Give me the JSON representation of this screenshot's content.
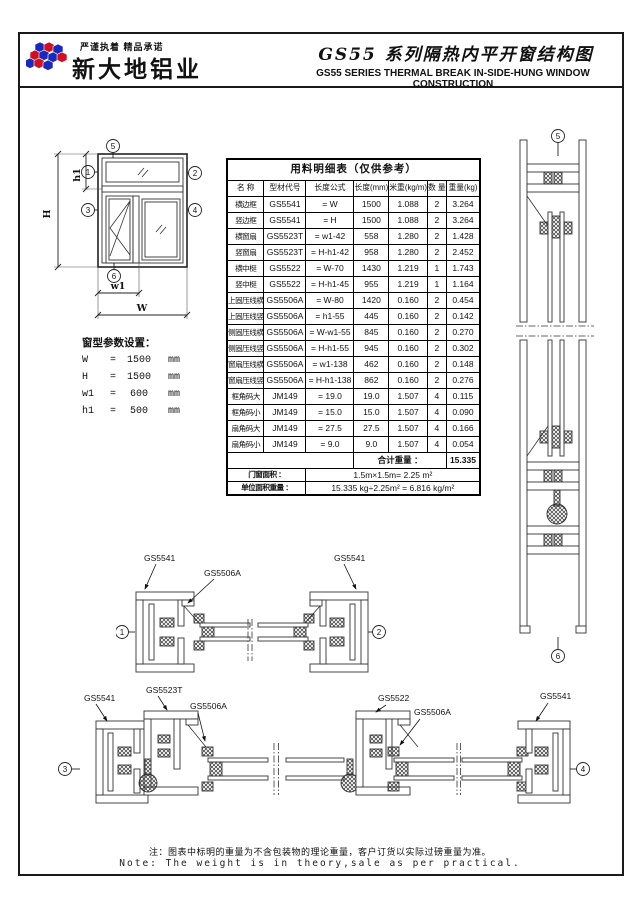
{
  "header": {
    "slogan": "严谨执着  精品承诺",
    "company": "新大地铝业",
    "title_cn": "GS55 系列隔热内平开窗结构图",
    "title_en": "GS55 SERIES THERMAL BREAK IN-SIDE-HUNG WINDOW CONSTRUCTION",
    "logo_blue": "#1828c0",
    "logo_red": "#d01020"
  },
  "window_diagram": {
    "refs": {
      "r1": "1",
      "r2": "2",
      "r3": "3",
      "r4": "4",
      "r5": "5",
      "r6": "6"
    },
    "dims": {
      "W": "W",
      "H": "H",
      "w1": "w1",
      "h1": "h1"
    }
  },
  "params": {
    "title": "窗型参数设置：",
    "rows": [
      {
        "name": "W",
        "eq": "=",
        "value": "1500",
        "unit": "mm"
      },
      {
        "name": "H",
        "eq": "=",
        "value": "1500",
        "unit": "mm"
      },
      {
        "name": "w1",
        "eq": "=",
        "value": "600",
        "unit": "mm"
      },
      {
        "name": "h1",
        "eq": "=",
        "value": "500",
        "unit": "mm"
      }
    ]
  },
  "table": {
    "title": "用料明细表（仅供参考）",
    "headers": [
      "名 称",
      "型材代号",
      "长度公式",
      "长度(mm)",
      "米重(kg/m)",
      "数 量",
      "重量(kg)"
    ],
    "rows": [
      [
        "横边框",
        "GS5541",
        "= W",
        "1500",
        "1.088",
        "2",
        "3.264"
      ],
      [
        "竖边框",
        "GS5541",
        "= H",
        "1500",
        "1.088",
        "2",
        "3.264"
      ],
      [
        "横窗扇",
        "GS5523T",
        "= w1-42",
        "558",
        "1.280",
        "2",
        "1.428"
      ],
      [
        "竖窗扇",
        "GS5523T",
        "= H-h1-42",
        "958",
        "1.280",
        "2",
        "2.452"
      ],
      [
        "横中梃",
        "GS5522",
        "= W-70",
        "1430",
        "1.219",
        "1",
        "1.743"
      ],
      [
        "竖中梃",
        "GS5522",
        "= H-h1-45",
        "955",
        "1.219",
        "1",
        "1.164"
      ],
      [
        "上固压线横",
        "GS5506A",
        "= W-80",
        "1420",
        "0.160",
        "2",
        "0.454"
      ],
      [
        "上固压线竖",
        "GS5506A",
        "= h1-55",
        "445",
        "0.160",
        "2",
        "0.142"
      ],
      [
        "侧固压线横",
        "GS5506A",
        "= W-w1-55",
        "845",
        "0.160",
        "2",
        "0.270"
      ],
      [
        "侧固压线竖",
        "GS5506A",
        "= H-h1-55",
        "945",
        "0.160",
        "2",
        "0.302"
      ],
      [
        "窗扇压线横",
        "GS5506A",
        "= w1-138",
        "462",
        "0.160",
        "2",
        "0.148"
      ],
      [
        "窗扇压线竖",
        "GS5506A",
        "= H-h1-138",
        "862",
        "0.160",
        "2",
        "0.276"
      ],
      [
        "框角码大",
        "JM149",
        "= 19.0",
        "19.0",
        "1.507",
        "4",
        "0.115"
      ],
      [
        "框角码小",
        "JM149",
        "= 15.0",
        "15.0",
        "1.507",
        "4",
        "0.090"
      ],
      [
        "扇角码大",
        "JM149",
        "= 27.5",
        "27.5",
        "1.507",
        "4",
        "0.166"
      ],
      [
        "扇角码小",
        "JM149",
        "= 9.0",
        "9.0",
        "1.507",
        "4",
        "0.054"
      ]
    ],
    "total_label": "合计重量 ：",
    "total_value": "15.335",
    "area_label": "门窗面积 ：",
    "area_value": "1.5m×1.5m= 2.25 m²",
    "unit_weight_label": "单位面积重量 ：",
    "unit_weight_value": "15.335 kg÷2.25m² = 6.816 kg/m²"
  },
  "sections": {
    "middle": {
      "label_frame_left": "GS5541",
      "label_bead": "GS5506A",
      "label_frame_right": "GS5541",
      "ref_left": "1",
      "ref_right": "2"
    },
    "bottom": {
      "label_frame_left": "GS5541",
      "label_sash": "GS5523T",
      "label_bead_left": "GS5506A",
      "label_mullion": "GS5522",
      "label_bead_right": "GS5506A",
      "label_frame_right": "GS5541",
      "ref_left": "3",
      "ref_right": "4"
    },
    "right_strip": {
      "ref_top": "5",
      "ref_bottom": "6"
    }
  },
  "footer": {
    "note_cn": "注：图表中标明的重量为不含包装物的理论重量，客户订货以实际过磅重量为准。",
    "note_en": "Note: The weight is in theory,sale as per practical."
  }
}
